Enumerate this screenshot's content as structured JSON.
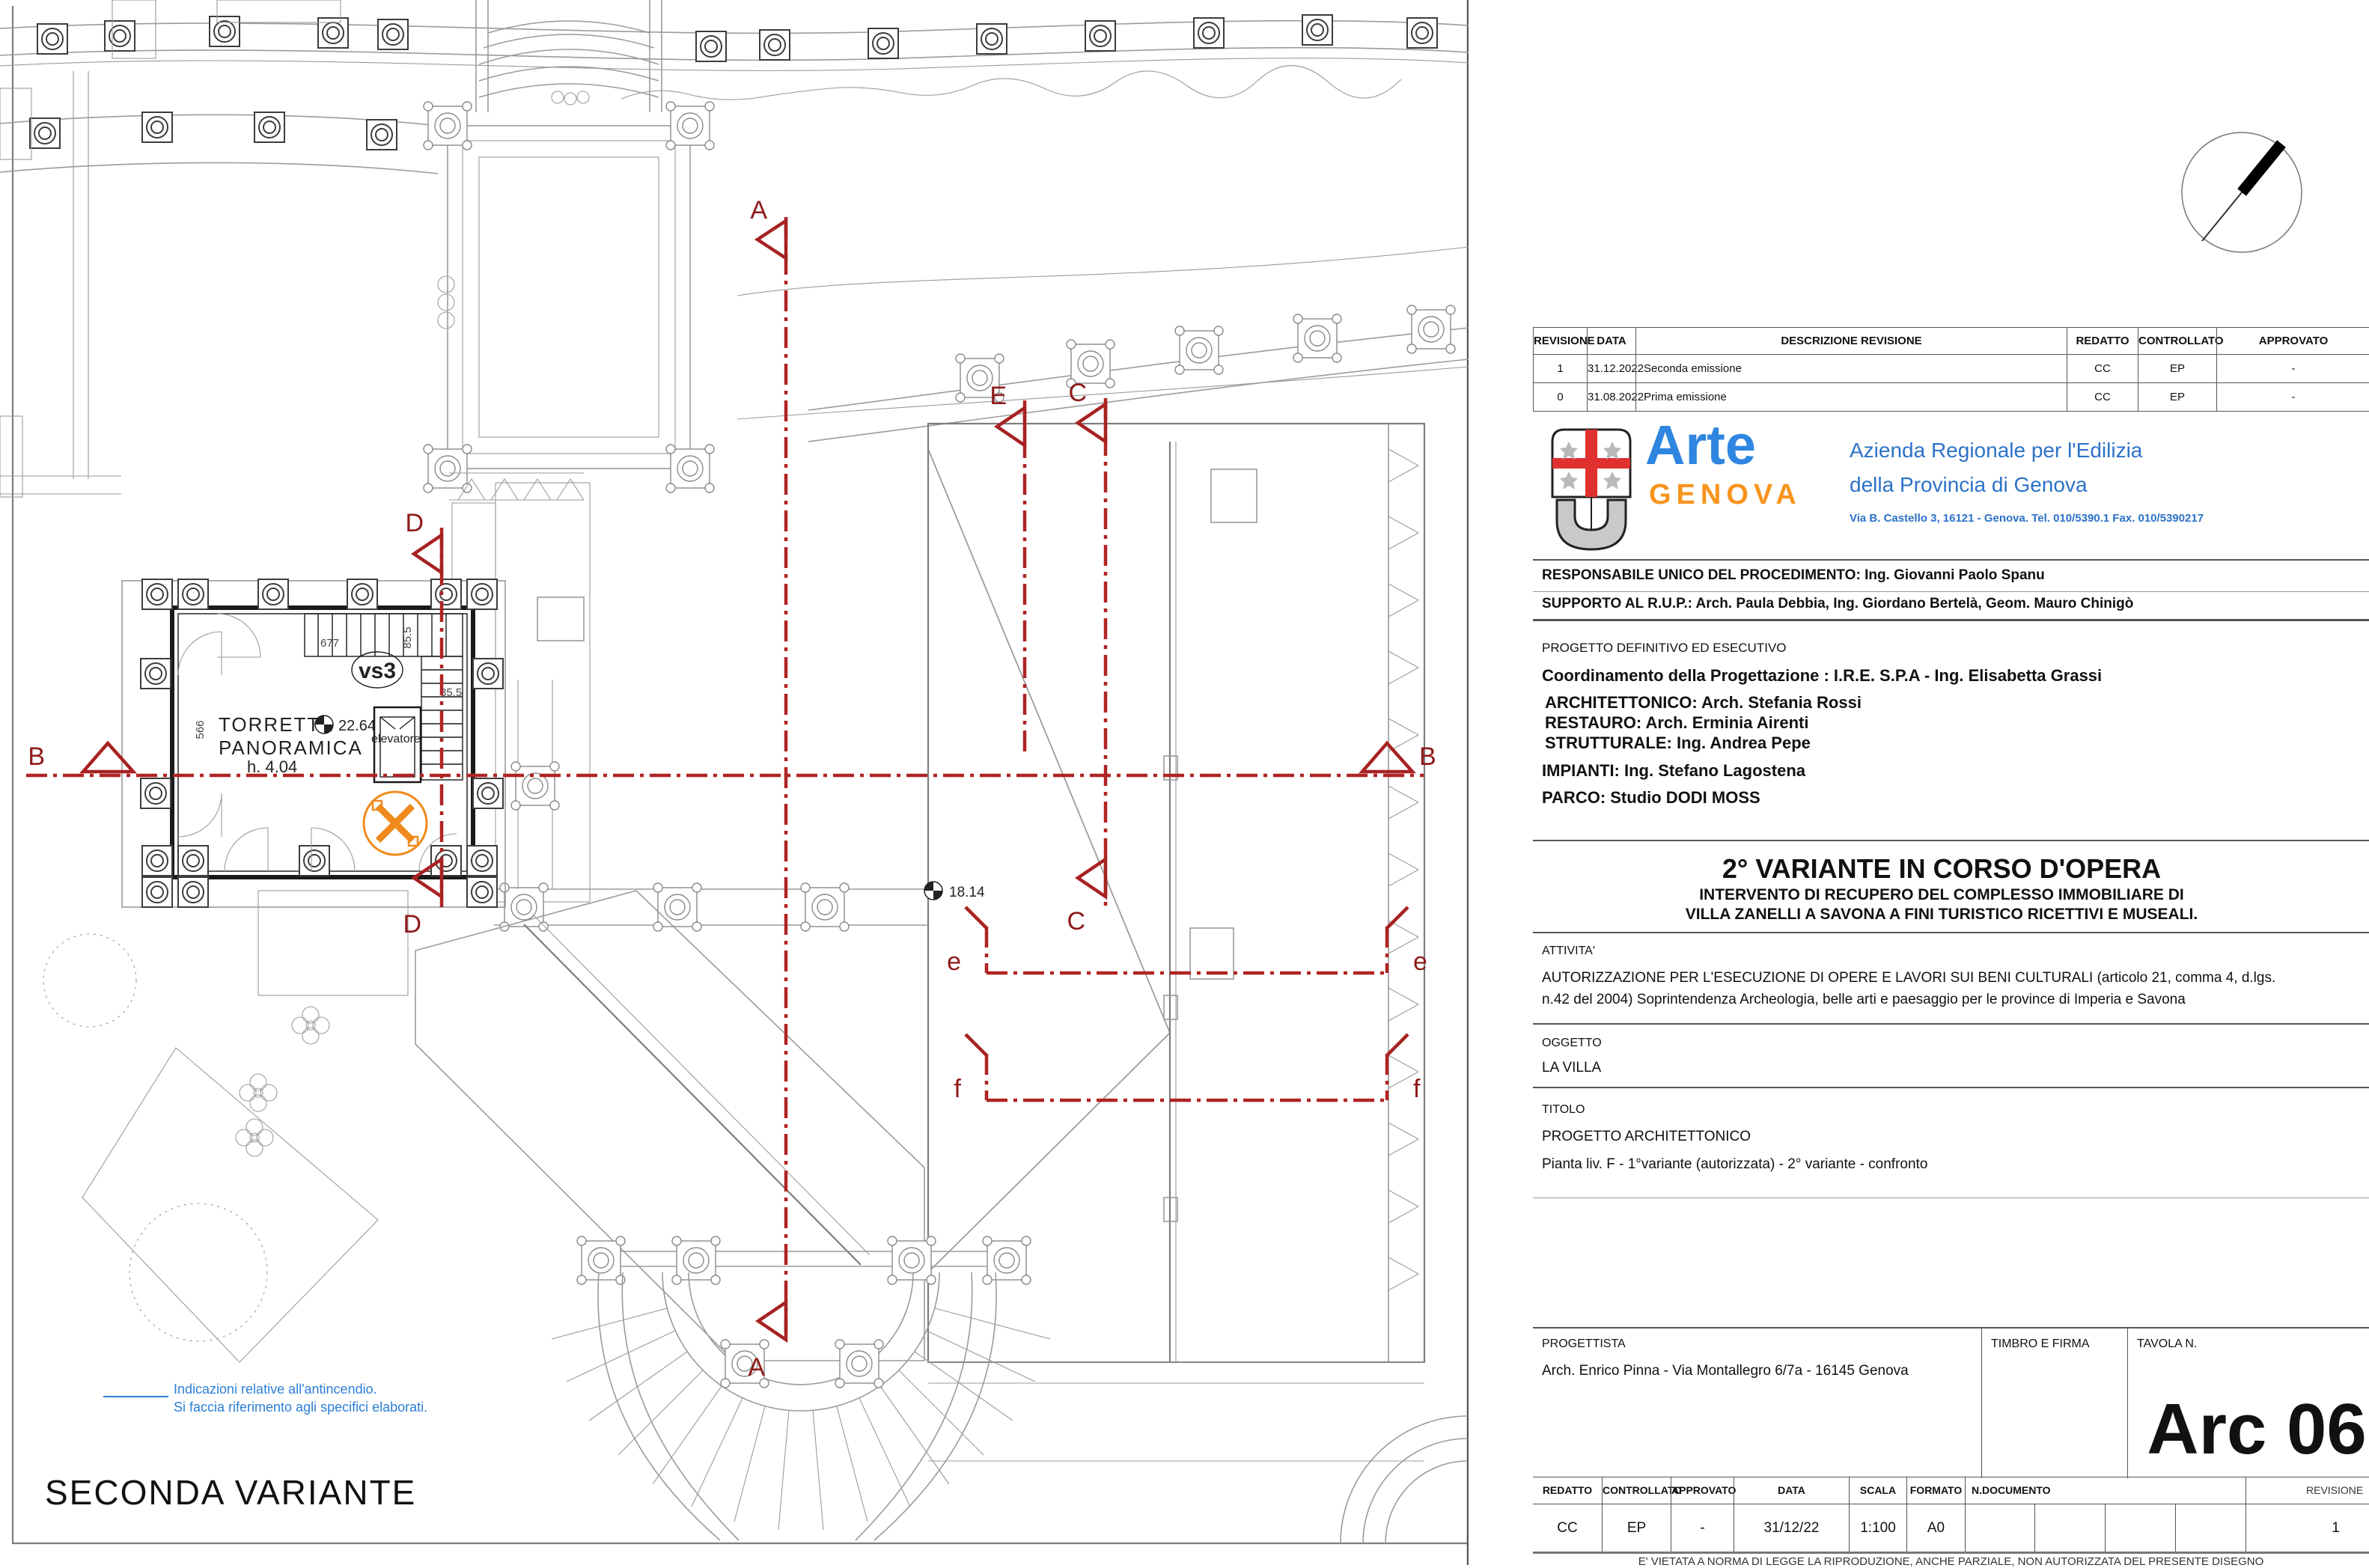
{
  "colors": {
    "section_red": "#A82222",
    "legend_blue": "#2B7FD6",
    "logo_blue": "#2E86E0",
    "logo_orange": "#F7941D",
    "agency_blue": "#2C72C8",
    "symbol_orange": "#F08A1D"
  },
  "plan": {
    "variant_label": "SECONDA VARIANTE",
    "legend_line1": "Indicazioni relative all'antincendio.",
    "legend_line2": "Si faccia riferimento agli specifici elaborati.",
    "room_name_line1": "TORRETTA",
    "room_name_line2": "PANORAMICA",
    "room_height": "h. 4.04",
    "level_tower": "22.64",
    "level_terrace": "18.14",
    "elevator_label": "elevatore",
    "stair_code": "vs3",
    "dim_677": "677",
    "dim_85_a": "85.5",
    "dim_85_b": "85.5",
    "dim_566": "566",
    "sections": {
      "a": "A",
      "b": "B",
      "c": "C",
      "d": "D",
      "e_cap": "E",
      "e": "e",
      "f": "f"
    }
  },
  "titleblock": {
    "revision_table": {
      "headers": [
        "REVISIONE",
        "DATA",
        "DESCRIZIONE REVISIONE",
        "REDATTO",
        "CONTROLLATO",
        "APPROVATO"
      ],
      "rows": [
        {
          "rev": "1",
          "date": "31.12.2022",
          "desc": "Seconda emissione",
          "red": "CC",
          "con": "EP",
          "app": "-"
        },
        {
          "rev": "0",
          "date": "31.08.2022",
          "desc": "Prima emissione",
          "red": "CC",
          "con": "EP",
          "app": "-"
        }
      ]
    },
    "agency": {
      "logo_word": "Arte",
      "logo_city": "GENOVA",
      "name_line1": "Azienda Regionale per l'Edilizia",
      "name_line2": "della Provincia di Genova",
      "address": "Via B. Castello 3, 16121 - Genova. Tel. 010/5390.1 Fax. 010/5390217"
    },
    "responsabile": "RESPONSABILE UNICO DEL PROCEDIMENTO: Ing. Giovanni Paolo Spanu",
    "supporto": "SUPPORTO AL R.U.P.: Arch. Paula Debbia, Ing. Giordano Bertelà, Geom. Mauro Chinigò",
    "progetto_fase": "PROGETTO DEFINITIVO ED ESECUTIVO",
    "coordinamento": "Coordinamento della Progettazione  : I.R.E. S.P.A  - Ing. Elisabetta Grassi",
    "team": [
      "ARCHITETTONICO: Arch. Stefania Rossi",
      "RESTAURO: Arch. Erminia Airenti",
      "STRUTTURALE: Ing. Andrea Pepe",
      "IMPIANTI: Ing. Stefano Lagostena",
      "PARCO: Studio DODI MOSS"
    ],
    "variante_title": "2° VARIANTE IN CORSO D'OPERA",
    "variante_sub1": "INTERVENTO DI RECUPERO DEL COMPLESSO IMMOBILIARE DI",
    "variante_sub2": "VILLA ZANELLI A SAVONA A FINI TURISTICO RICETTIVI E MUSEALI.",
    "attivita_label": "ATTIVITA'",
    "attivita_line1": "AUTORIZZAZIONE PER L'ESECUZIONE DI OPERE E LAVORI SUI BENI CULTURALI (articolo 21, comma 4, d.lgs.",
    "attivita_line2": "n.42 del 2004) Soprintendenza Archeologia, belle arti e paesaggio per le province di Imperia e Savona",
    "oggetto_label": "OGGETTO",
    "oggetto_value": "LA VILLA",
    "titolo_label": "TITOLO",
    "titolo_line1": "PROGETTO ARCHITETTONICO",
    "titolo_line2": "Pianta liv. F -  1°variante (autorizzata) - 2° variante - confronto",
    "progettista_label": "PROGETTISTA",
    "progettista_value": "Arch. Enrico Pinna - Via Montallegro 6/7a - 16145 Genova",
    "timbro_label": "TIMBRO E FIRMA",
    "tavola_label": "TAVOLA N.",
    "tavola_number": "Arc 06",
    "bottom_table": {
      "headers": [
        "REDATTO",
        "CONTROLLATO",
        "APPROVATO",
        "DATA",
        "SCALA",
        "FORMATO",
        "N.DOCUMENTO",
        "REVISIONE"
      ],
      "values": {
        "redatto": "CC",
        "controllato": "EP",
        "approvato": "-",
        "data": "31/12/22",
        "scala": "1:100",
        "formato": "A0",
        "ndocumento": "",
        "revisione": "1"
      }
    },
    "disclaimer": "E' VIETATA A NORMA DI LEGGE LA RIPRODUZIONE, ANCHE PARZIALE, NON AUTORIZZATA DEL PRESENTE DISEGNO"
  }
}
